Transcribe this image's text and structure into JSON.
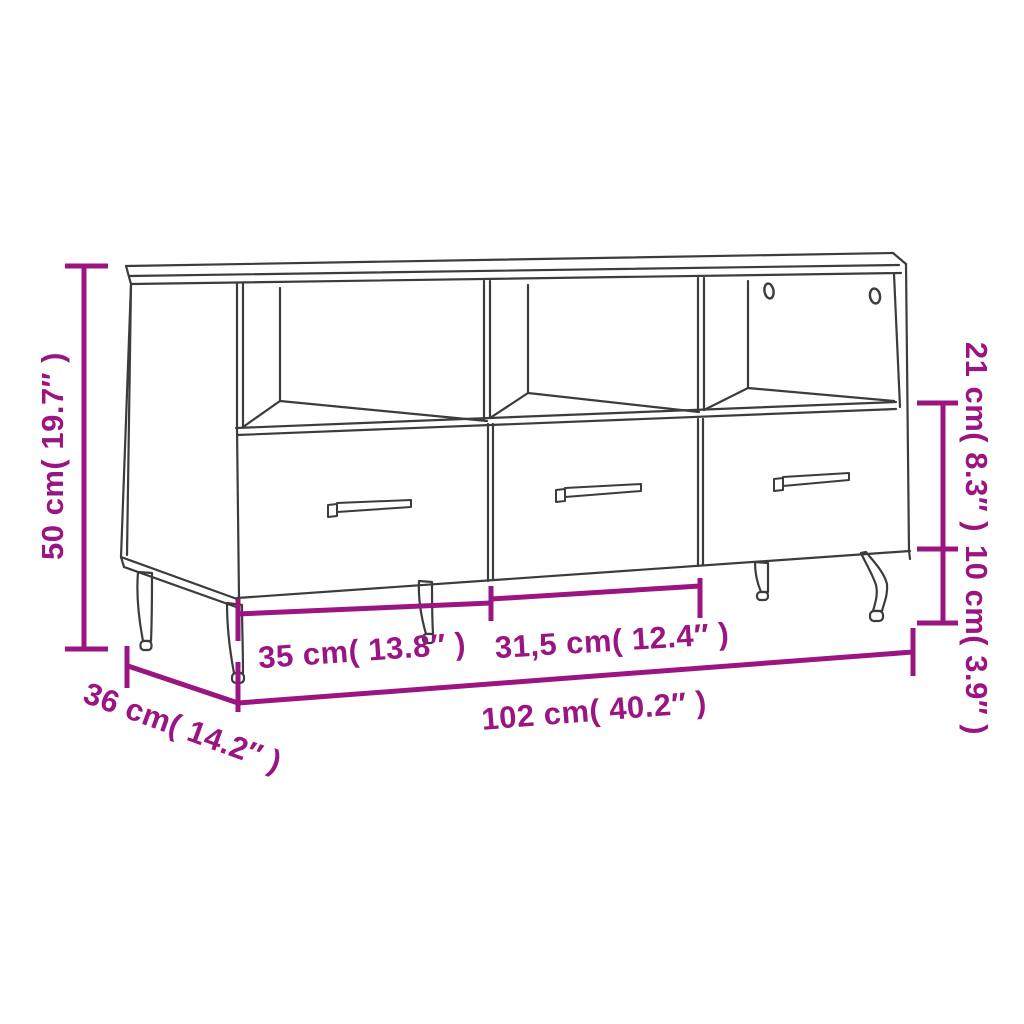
{
  "image": {
    "background_color": "#FFFFFF",
    "line_color": "#3C3C3C",
    "accent_color": "#9A1482"
  },
  "figure": {
    "subject": "TV cabinet line drawing with 3 open compartments, 3 drawers with bar handles, 2 cable holes and tapered metal legs",
    "compartments": 3,
    "drawers": 3,
    "cable_holes": 2,
    "legs_visible": 5
  },
  "dimensions": {
    "height": {
      "label": "50 cm( 19.7″ )"
    },
    "depth": {
      "label": "36 cm( 14.2″ )"
    },
    "width": {
      "label": "102 cm( 40.2″ )"
    },
    "drawer_left_width": {
      "label": "35 cm( 13.8″ )"
    },
    "drawer_middle_width": {
      "label": "31,5 cm( 12.4″ )"
    },
    "upper_section_height": {
      "label": "21 cm( 8.3″ )"
    },
    "leg_height": {
      "label": "10 cm( 3.9″ )"
    }
  }
}
